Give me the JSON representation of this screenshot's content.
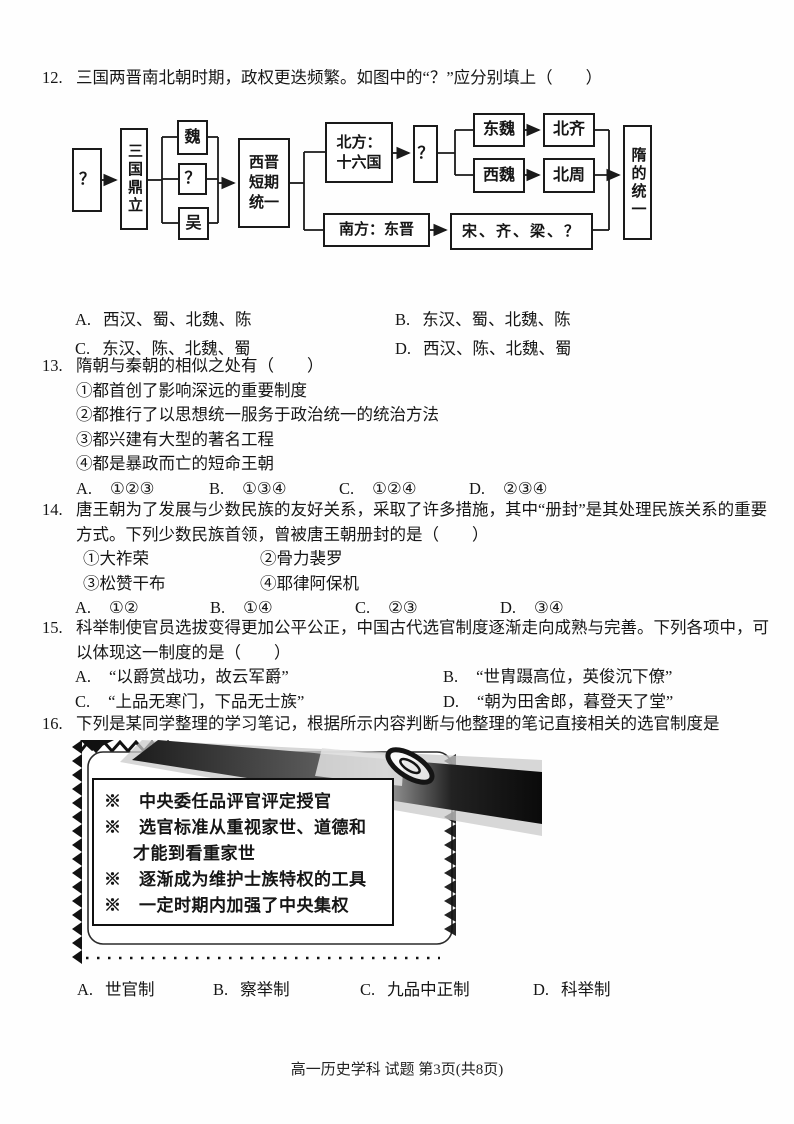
{
  "footer": {
    "text": "高一历史学科 试题 第3页(共8页)"
  },
  "q12": {
    "number": "12.",
    "stem": "三国两晋南北朝时期，政权更迭频繁。如图中的“？”应分别填上（　　）",
    "diagram": {
      "q_left": "？",
      "three_kingdoms": "三国鼎立",
      "wei": "魏",
      "q_mid": "？",
      "wu": "吴",
      "west_jin": "西晋\n短期\n统一",
      "north": "北方：\n十六国",
      "q_right": "？",
      "dong_wei": "东魏",
      "bei_qi": "北齐",
      "xi_wei": "西魏",
      "bei_zhou": "北周",
      "sui_unification": "隋的统一",
      "south": "南方：东晋",
      "song_qi_liang": "宋、齐、梁、？"
    },
    "options": [
      {
        "label": "A.",
        "text": "西汉、蜀、北魏、陈"
      },
      {
        "label": "B.",
        "text": "东汉、蜀、北魏、陈"
      },
      {
        "label": "C.",
        "text": "东汉、陈、北魏、蜀"
      },
      {
        "label": "D.",
        "text": "西汉、陈、北魏、蜀"
      }
    ]
  },
  "q13": {
    "number": "13.",
    "stem": "隋朝与秦朝的相似之处有（　　）",
    "items": [
      "①都首创了影响深远的重要制度",
      "②都推行了以思想统一服务于政治统一的统治方法",
      "③都兴建有大型的著名工程",
      "④都是暴政而亡的短命王朝"
    ],
    "options": [
      {
        "label": "A.",
        "text": "①②③"
      },
      {
        "label": "B.",
        "text": "①③④"
      },
      {
        "label": "C.",
        "text": "①②④"
      },
      {
        "label": "D.",
        "text": "②③④"
      }
    ]
  },
  "q14": {
    "number": "14.",
    "stem": "唐王朝为了发展与少数民族的友好关系，采取了许多措施，其中“册封”是其处理民族关系的重要方式。下列少数民族首领，曾被唐王朝册封的是（　　）",
    "items": [
      "①大祚荣",
      "②骨力裴罗",
      "③松赞干布",
      "④耶律阿保机"
    ],
    "options": [
      {
        "label": "A.",
        "text": "①②"
      },
      {
        "label": "B.",
        "text": "①④"
      },
      {
        "label": "C.",
        "text": "②③"
      },
      {
        "label": "D.",
        "text": "③④"
      }
    ]
  },
  "q15": {
    "number": "15.",
    "stem": "科举制使官员选拔变得更加公平公正，中国古代选官制度逐渐走向成熟与完善。下列各项中，可以体现这一制度的是（　　）",
    "options": [
      {
        "label": "A.",
        "text": "“以爵赏战功，故云军爵”"
      },
      {
        "label": "B.",
        "text": "“世胄蹑高位，英俊沉下僚”"
      },
      {
        "label": "C.",
        "text": "“上品无寒门，下品无士族”"
      },
      {
        "label": "D.",
        "text": "“朝为田舍郎，暮登天了堂”"
      }
    ]
  },
  "q16": {
    "number": "16.",
    "stem": "下列是某同学整理的学习笔记，根据所示内容判断与他整理的笔记直接相关的选官制度是",
    "notebook_lines": [
      "※　中央委任品评官评定授官",
      "※　选官标准从重视家世、道德和",
      "才能到看重家世",
      "※　逐渐成为维护士族特权的工具",
      "※　一定时期内加强了中央集权"
    ],
    "options": [
      {
        "label": "A.",
        "text": "世官制"
      },
      {
        "label": "B.",
        "text": "察举制"
      },
      {
        "label": "C.",
        "text": "九品中正制"
      },
      {
        "label": "D.",
        "text": "科举制"
      }
    ]
  }
}
